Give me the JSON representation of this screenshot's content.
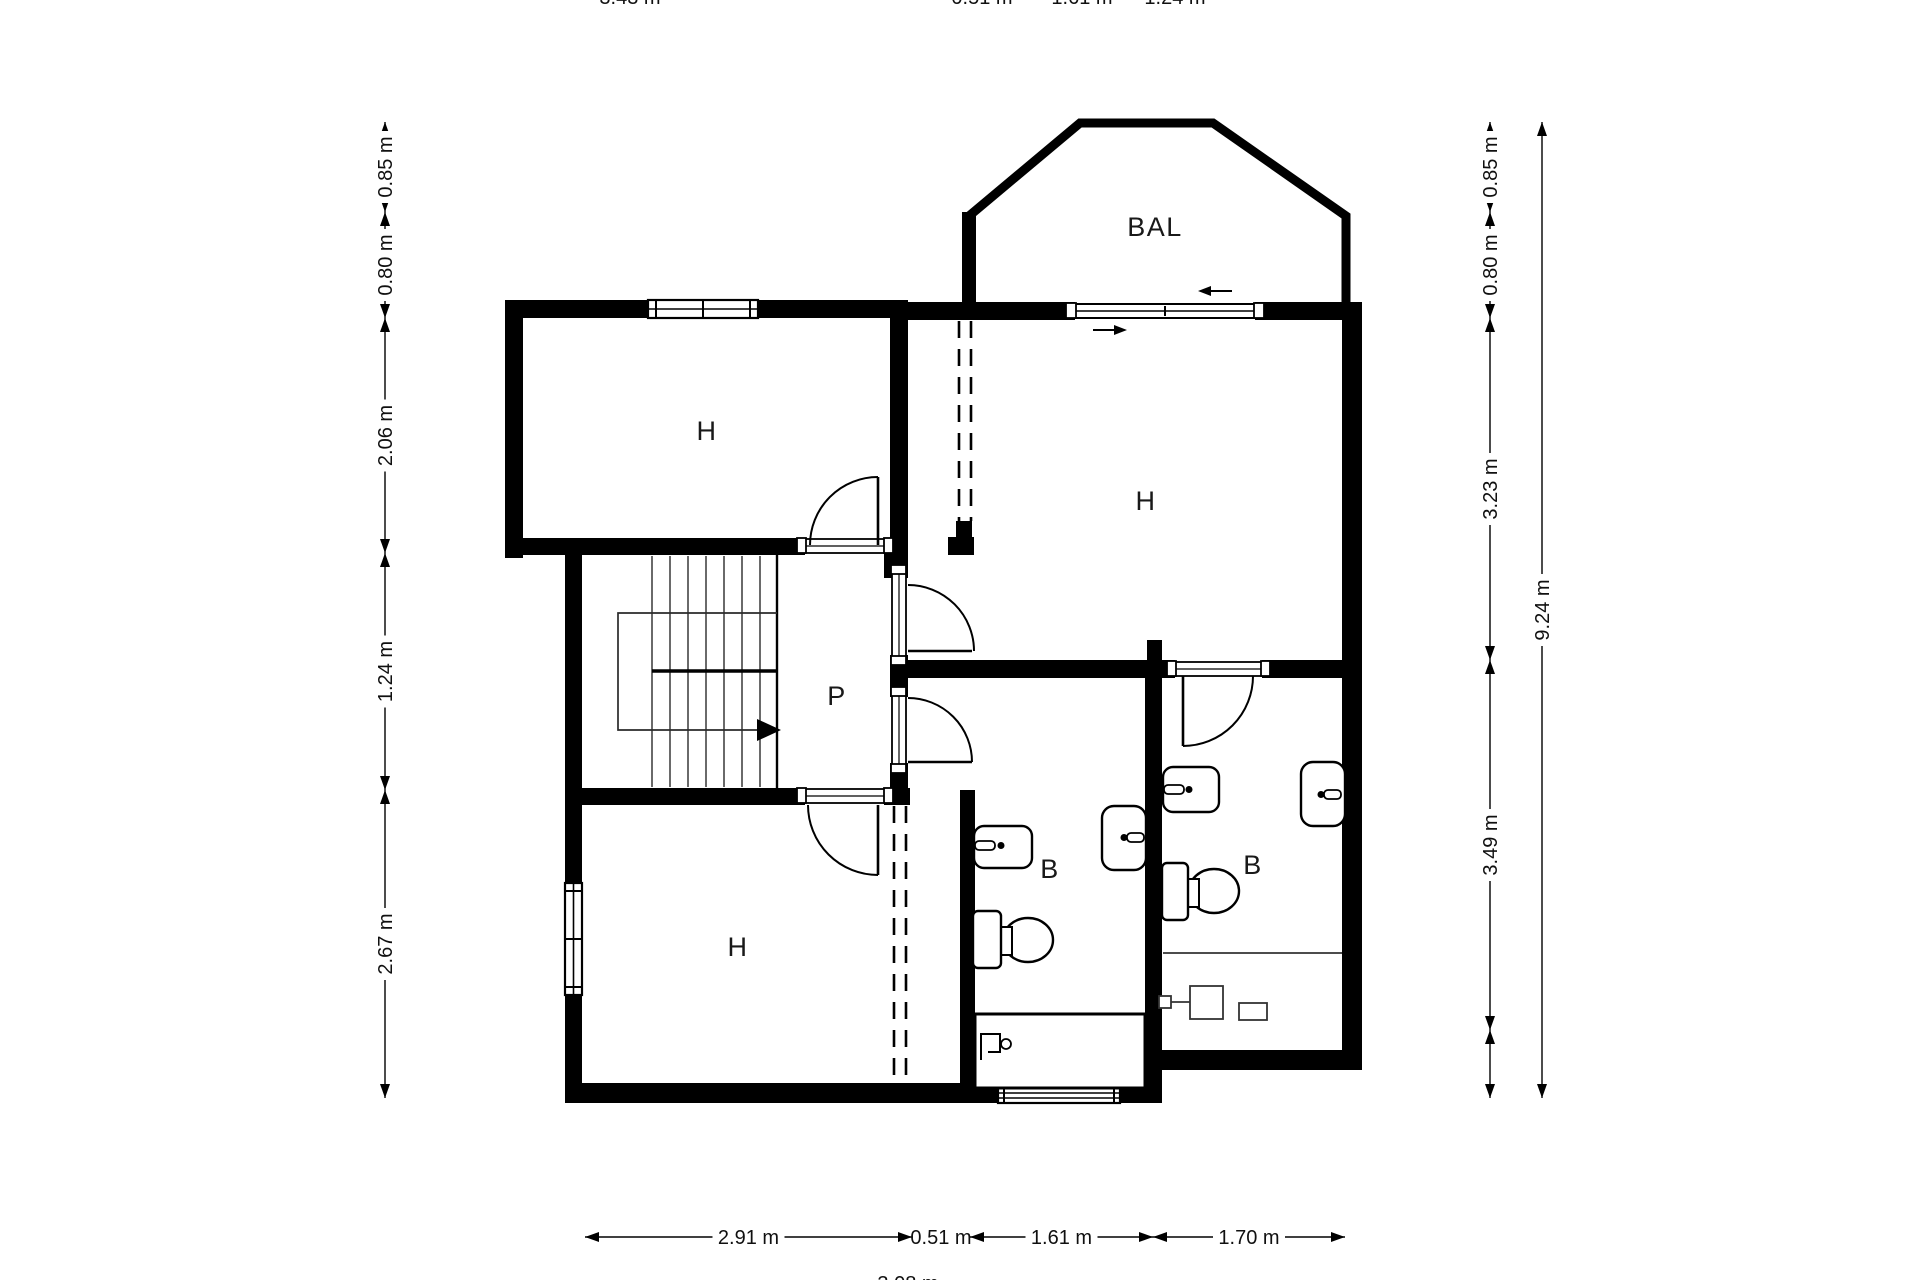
{
  "meta": {
    "title": "Floor plan",
    "canvas": {
      "w": 1920,
      "h": 1280,
      "bg": "#ffffff",
      "ink": "#000000"
    }
  },
  "room_labels": [
    {
      "text": "H",
      "x": 707,
      "y": 440
    },
    {
      "text": "H",
      "x": 1146,
      "y": 510
    },
    {
      "text": "H",
      "x": 738,
      "y": 956
    },
    {
      "text": "P",
      "x": 837,
      "y": 705
    },
    {
      "text": "B",
      "x": 1050,
      "y": 878
    },
    {
      "text": "B",
      "x": 1253,
      "y": 874
    },
    {
      "text": "BAL",
      "x": 1155,
      "y": 236
    }
  ],
  "walls": [
    [
      505,
      300,
      143,
      18
    ],
    [
      758,
      300,
      150,
      18
    ],
    [
      505,
      300,
      18,
      258
    ],
    [
      505,
      538,
      300,
      17
    ],
    [
      884,
      538,
      24,
      40
    ],
    [
      890,
      300,
      18,
      273
    ],
    [
      890,
      655,
      18,
      42
    ],
    [
      890,
      763,
      18,
      42
    ],
    [
      890,
      660,
      272,
      18
    ],
    [
      1162,
      660,
      13,
      18
    ],
    [
      1262,
      660,
      100,
      18
    ],
    [
      908,
      302,
      167,
      18
    ],
    [
      1255,
      302,
      107,
      18
    ],
    [
      1342,
      310,
      20,
      760
    ],
    [
      1147,
      640,
      15,
      24
    ],
    [
      1145,
      678,
      17,
      425
    ],
    [
      956,
      521,
      16,
      16
    ],
    [
      948,
      537,
      26,
      18
    ],
    [
      960,
      790,
      15,
      313
    ],
    [
      565,
      553,
      17,
      330
    ],
    [
      565,
      995,
      17,
      108
    ],
    [
      565,
      1083,
      433,
      20
    ],
    [
      1120,
      1083,
      42,
      20
    ],
    [
      1150,
      1050,
      212,
      20
    ],
    [
      565,
      788,
      240,
      17
    ],
    [
      884,
      788,
      26,
      17
    ],
    [
      962,
      212,
      14,
      100
    ]
  ],
  "balcony_path": "M 969 312 L 969 216 L 1080 123 L 1213 123 L 1346 216 L 1346 312",
  "dashed_lines": [
    [
      959,
      321,
      959,
      521
    ],
    [
      971,
      321,
      971,
      521
    ],
    [
      894,
      806,
      894,
      1081
    ],
    [
      906,
      806,
      906,
      1081
    ]
  ],
  "windows": [
    {
      "kind": "double-h",
      "x": 648,
      "y": 300,
      "w": 110,
      "h": 18
    },
    {
      "kind": "double-v",
      "x": 565,
      "y": 883,
      "w": 17,
      "h": 112
    },
    {
      "kind": "louver-h",
      "x": 998,
      "y": 1083,
      "w": 122,
      "h": 20
    }
  ],
  "sliding_door": {
    "x": 1075,
    "y": 304,
    "w": 180,
    "h": 14
  },
  "slide_arrows": [
    {
      "line": [
        1232,
        291,
        1202,
        291
      ],
      "head": [
        [
          1198,
          291
        ],
        [
          1211,
          286
        ],
        [
          1211,
          296
        ]
      ]
    },
    {
      "line": [
        1093,
        330,
        1123,
        330
      ],
      "head": [
        [
          1127,
          330
        ],
        [
          1114,
          325
        ],
        [
          1114,
          335
        ]
      ]
    }
  ],
  "thresholds": [
    {
      "x": 805,
      "y": 539,
      "w": 80,
      "h": 14,
      "o": "h"
    },
    {
      "x": 805,
      "y": 789,
      "w": 80,
      "h": 14,
      "o": "h"
    },
    {
      "x": 892,
      "y": 573,
      "w": 14,
      "h": 84,
      "o": "v"
    },
    {
      "x": 892,
      "y": 695,
      "w": 14,
      "h": 70,
      "o": "v"
    },
    {
      "x": 1175,
      "y": 662,
      "w": 87,
      "h": 14,
      "o": "h"
    }
  ],
  "end_squares": [
    [
      797,
      538,
      9,
      15
    ],
    [
      884,
      538,
      9,
      15
    ],
    [
      797,
      788,
      9,
      15
    ],
    [
      884,
      788,
      9,
      15
    ],
    [
      891,
      565,
      15,
      9
    ],
    [
      891,
      656,
      15,
      9
    ],
    [
      891,
      687,
      15,
      9
    ],
    [
      891,
      764,
      15,
      9
    ],
    [
      1167,
      661,
      9,
      15
    ],
    [
      1261,
      661,
      9,
      15
    ],
    [
      1066,
      303,
      10,
      15
    ],
    [
      1254,
      303,
      10,
      15
    ]
  ],
  "doors": [
    {
      "leaf": [
        878,
        545,
        878,
        477
      ],
      "arc": "M 810 545 A 68 68 0 0 1 878 477"
    },
    {
      "leaf": [
        878,
        805,
        878,
        875
      ],
      "arc": "M 808 805 A 70 70 0 0 0 878 875"
    },
    {
      "leaf": [
        908,
        651,
        972,
        651
      ],
      "arc": "M 908 585 A 66 66 0 0 1 974 651"
    },
    {
      "leaf": [
        908,
        762,
        972,
        762
      ],
      "arc": "M 908 698 A 64 64 0 0 1 972 762"
    },
    {
      "leaf": [
        1183,
        676,
        1183,
        746
      ],
      "arc": "M 1253 676 A 70 70 0 0 1 1183 746"
    }
  ],
  "stairs": {
    "right_edge": [
      777,
      555,
      777,
      788
    ],
    "treads_x": [
      652,
      670,
      688,
      706,
      724,
      742,
      760
    ],
    "tread_y": [
      556,
      787
    ],
    "divider": [
      652,
      671,
      777,
      671
    ],
    "path_polyline": "777,613 618,613 618,730 757,730",
    "arrow": [
      [
        757,
        719
      ],
      [
        757,
        741
      ],
      [
        781,
        730
      ]
    ]
  },
  "fixtures": {
    "sinks": [
      {
        "x": 974,
        "y": 826,
        "w": 58,
        "h": 42,
        "rx": 10,
        "bar": [
          975,
          841,
          20,
          9
        ],
        "dot": [
          1001,
          845.5
        ]
      },
      {
        "x": 1102,
        "y": 806,
        "w": 44,
        "h": 64,
        "rx": 12,
        "bar": [
          1127,
          833,
          17,
          9
        ],
        "dot": [
          1124,
          837.5
        ]
      },
      {
        "x": 1163,
        "y": 767,
        "w": 56,
        "h": 45,
        "rx": 10,
        "bar": [
          1164,
          785,
          20,
          9
        ],
        "dot": [
          1189,
          789.5
        ]
      },
      {
        "x": 1301,
        "y": 762,
        "w": 44,
        "h": 64,
        "rx": 12,
        "bar": [
          1324,
          790,
          17,
          9
        ],
        "dot": [
          1321,
          794.5
        ]
      }
    ],
    "toilets": [
      {
        "tank": [
          973,
          911,
          28,
          57
        ],
        "neck": [
          998,
          927,
          14,
          28
        ],
        "bowl": [
          1028,
          940,
          25,
          22
        ]
      },
      {
        "tank": [
          1162,
          863,
          26,
          57
        ],
        "neck": [
          1185,
          879,
          14,
          28
        ],
        "bowl": [
          1214,
          891,
          25,
          22
        ]
      }
    ],
    "tub": {
      "rect": [
        975,
        1014,
        170,
        74
      ],
      "pipe": "981,1060 981,1034 1000,1034 1000,1052 988,1052",
      "ring": [
        1006,
        1044,
        5
      ]
    },
    "misc_lines": [
      [
        1163,
        953,
        1342,
        953
      ],
      [
        1163,
        1002,
        1207,
        1002
      ]
    ],
    "misc_rects": [
      [
        1190,
        986,
        33,
        33
      ],
      [
        1239,
        1003,
        28,
        17
      ],
      [
        1159,
        996,
        12,
        12
      ]
    ]
  },
  "dimensions": {
    "vertical": [
      {
        "x": 385,
        "segs": [
          {
            "a": 122,
            "b": 212,
            "t": "0.85 m"
          },
          {
            "a": 212,
            "b": 318,
            "t": "0.80 m"
          },
          {
            "a": 318,
            "b": 553,
            "t": "2.06 m"
          },
          {
            "a": 553,
            "b": 790,
            "t": "1.24 m"
          },
          {
            "a": 790,
            "b": 1098,
            "t": "2.67 m"
          }
        ]
      },
      {
        "x": 1490,
        "segs": [
          {
            "a": 122,
            "b": 212,
            "t": "0.85 m"
          },
          {
            "a": 212,
            "b": 318,
            "t": "0.80 m"
          },
          {
            "a": 318,
            "b": 660,
            "t": "3.23 m"
          },
          {
            "a": 660,
            "b": 1030,
            "t": "3.49 m"
          },
          {
            "a": 1030,
            "b": 1098,
            "t": ""
          }
        ]
      },
      {
        "x": 1542,
        "segs": [
          {
            "a": 122,
            "b": 1098,
            "t": "9.24 m"
          }
        ]
      }
    ],
    "horizontal": [
      {
        "y": 1237,
        "segs": [
          {
            "a": 585,
            "b": 912,
            "t": "2.91 m"
          },
          {
            "a": 912,
            "b": 970,
            "t": "0.51 m",
            "noarr": true
          },
          {
            "a": 970,
            "b": 1153,
            "t": "1.61 m"
          },
          {
            "a": 1153,
            "b": 1345,
            "t": "1.70 m"
          }
        ]
      }
    ],
    "cropped_top": {
      "baseline": 4,
      "items": [
        {
          "t": "3.43 m",
          "x": 630
        },
        {
          "t": "0.51 m",
          "x": 982
        },
        {
          "t": "1.61 m",
          "x": 1082
        },
        {
          "t": "1.24 m",
          "x": 1175
        }
      ]
    },
    "cropped_bottom": {
      "baseline": 1290,
      "items": [
        {
          "t": "3.08 m",
          "x": 908
        }
      ]
    }
  }
}
